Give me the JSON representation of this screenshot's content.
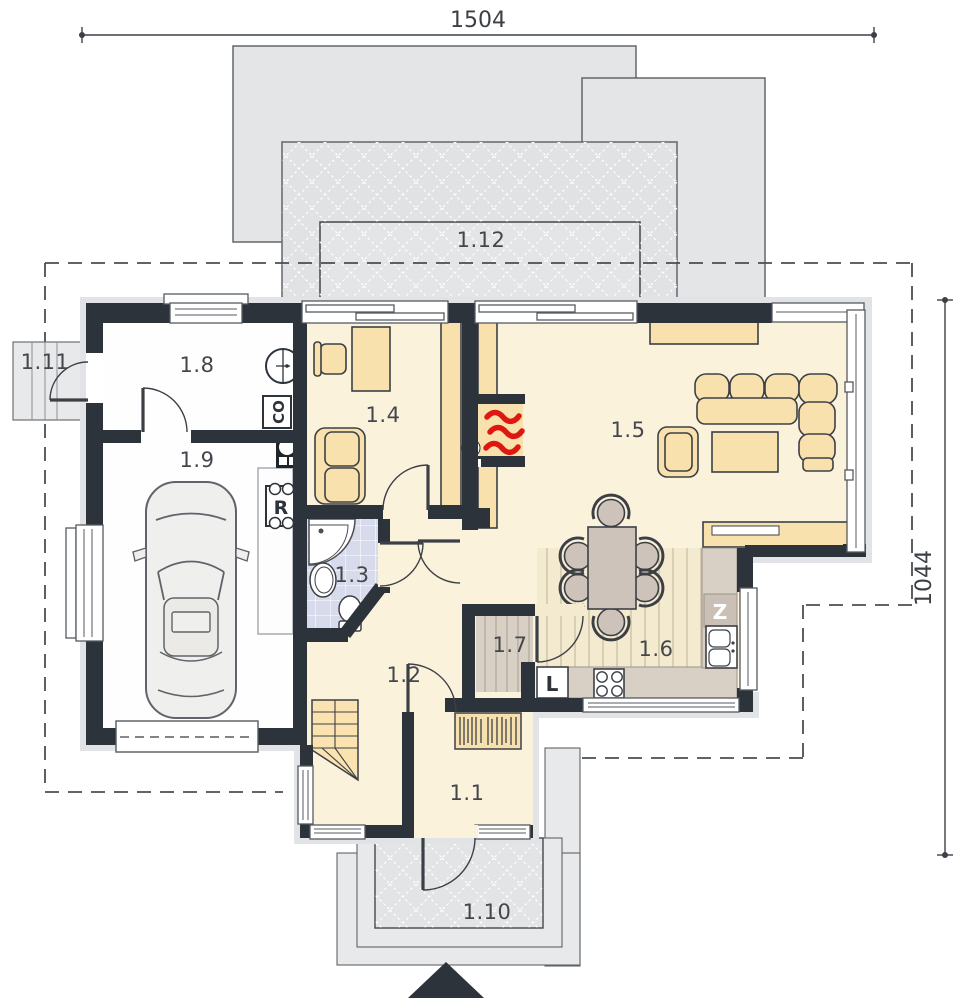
{
  "dimensions": {
    "top": "1504",
    "right": "1044"
  },
  "rooms": {
    "r1_1": "1.1",
    "r1_2": "1.2",
    "r1_3": "1.3",
    "r1_4": "1.4",
    "r1_5": "1.5",
    "r1_6": "1.6",
    "r1_7": "1.7",
    "r1_8": "1.8",
    "r1_9": "1.9",
    "r1_10": "1.10",
    "r1_11": "1.11",
    "r1_12": "1.12"
  },
  "markers": {
    "central_heating": "CO",
    "electrical_panel": "R",
    "fridge": "L",
    "kitchen_sink": "Z"
  },
  "colors": {
    "wall": "#2c333b",
    "floor_cream": "#fbf2dc",
    "furniture_tan": "#f8e1ac",
    "terrace_gray": "#e3e5e7",
    "bath_tile": "#d8dbeb",
    "flame_red": "#de1710"
  }
}
